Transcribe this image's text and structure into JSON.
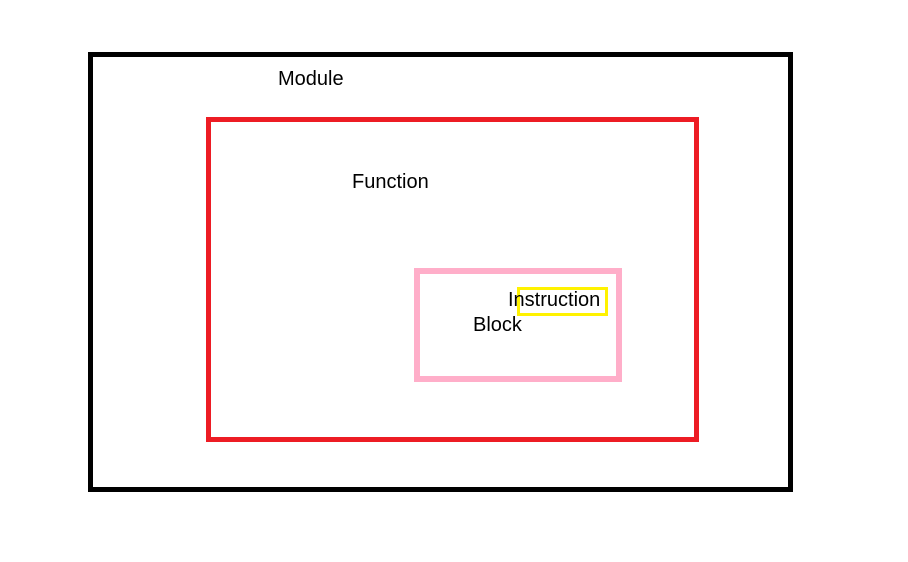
{
  "diagram": {
    "background_color": "#ffffff",
    "text_color": "#000000",
    "boxes": {
      "module": {
        "label": "Module",
        "border_color": "#000000"
      },
      "function": {
        "label": "Function",
        "border_color": "#ed1c24"
      },
      "block": {
        "label": "Block",
        "border_color": "#ffaec9"
      },
      "instruction": {
        "label": "Instruction",
        "border_color": "#fff200"
      }
    }
  }
}
